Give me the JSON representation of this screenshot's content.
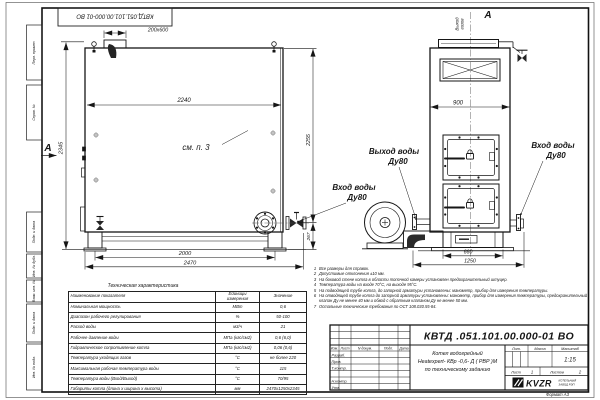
{
  "frame": {
    "format_note": "Формат А3"
  },
  "margin": {
    "labels": [
      "Перв. примен.",
      "Справ. №",
      "Подп. и дата",
      "Инв. № дубл.",
      "Взам. инв. №",
      "Подп. и дата",
      "Инв. № подл."
    ]
  },
  "labels": {
    "top_stamp": "КВТД.051.101.00.000-01 ВО",
    "view_a": "А",
    "see_p3": "см. п. 3",
    "gas_out_line1": "Выход",
    "gas_out_line2": "газов",
    "water_out_line1": "Выход воды",
    "water_out_line2": "Ду80",
    "water_in_line1": "Вход воды",
    "water_in_line2": "Ду80"
  },
  "dims": {
    "flue": "200x600",
    "body_length": "2240",
    "height_total": "2345",
    "height_right": "2255",
    "inlet_height": "267",
    "base_span": "2000",
    "overall_length": "2470",
    "front_width": "900",
    "base_width": "660",
    "overall_width": "1250"
  },
  "tech_table": {
    "title": "Техническая характеристика",
    "headers": [
      "Наименование показателя",
      "Единицы измерения",
      "Значение"
    ],
    "rows": [
      {
        "name": "Номинальная мощность",
        "unit": "МВт",
        "value": "0,6"
      },
      {
        "name": "Диапазон рабочего регулирования",
        "unit": "%",
        "value": "50-100"
      },
      {
        "name": "Расход воды",
        "unit": "м3/ч",
        "value": "21"
      },
      {
        "name": "Рабочее давление воды",
        "unit": "МПа (кгс/см2)",
        "value": "0,6 (6,0)"
      },
      {
        "name": "Гидравлическое сопротивление котла",
        "unit": "МПа (кгс/см2)",
        "value": "0,06 (0,6)"
      },
      {
        "name": "Температура уходящих газов",
        "unit": "°С",
        "value": "не более 220"
      },
      {
        "name": "Максимальная рабочая температура воды",
        "unit": "°С",
        "value": "115"
      },
      {
        "name": "Температура воды (Вход/Выход)",
        "unit": "°С",
        "value": "70/95"
      },
      {
        "name": "Габариты котла (длина х ширина х высота)",
        "unit": "мм",
        "value": "2470х1250х2345"
      }
    ]
  },
  "notes": {
    "items": [
      {
        "num": "1",
        "text": "Все размеры для справок."
      },
      {
        "num": "2",
        "text": "Допустимые отклонения ±10 мм."
      },
      {
        "num": "3",
        "text": "На боковой стене котла в области топочной камеры установлен предохранительный штуцер."
      },
      {
        "num": "4",
        "text": "Температура воды на входе 70°С, на выходе 95°С."
      },
      {
        "num": "5",
        "text": "На подводящей трубе котла, до запорной арматуры установлены: манометр, прибор для измерения температуры."
      },
      {
        "num": "6",
        "text": "На отводящей трубе котла до запорной арматуры установлены: манометр, прибор для измерения температуры, предохранительный клапан Ду не менее 40 мм и обвод с обратным клапаном Ду не менее 50 мм."
      },
      {
        "num": "7",
        "text": "Остальные технические требования по ОСТ 108.030.55-84."
      }
    ]
  },
  "title_block": {
    "doc_number": "КВТД .051.101.00.000-01  ВО",
    "name_line1": "Котел водогрейный",
    "name_line2": "Heatexpert- КВр -0,6- Д ( РВР )М",
    "name_line3": "по техническому заданию",
    "col_izm": "Изм.",
    "col_list": "Лист",
    "col_ndoc": "N докум.",
    "col_podp": "Подп.",
    "col_data": "Дата",
    "row_razrab": "Разраб.",
    "row_prov": "Пров.",
    "row_tkontr": "Т.контр.",
    "row_nkontr": "Н.контр.",
    "row_utv": "Утв.",
    "lit_label": "Лит.",
    "mass_label": "Масса",
    "scale_label": "Масштаб",
    "scale_value": "1:15",
    "sheet_label": "Лист",
    "sheet_value": "1",
    "sheets_label": "Листов",
    "sheets_value": "2",
    "logo_text": "KVZR",
    "company_line1": "КОТЕЛЬНЫЙ",
    "company_line2": "ЗАВОД РЭП"
  }
}
